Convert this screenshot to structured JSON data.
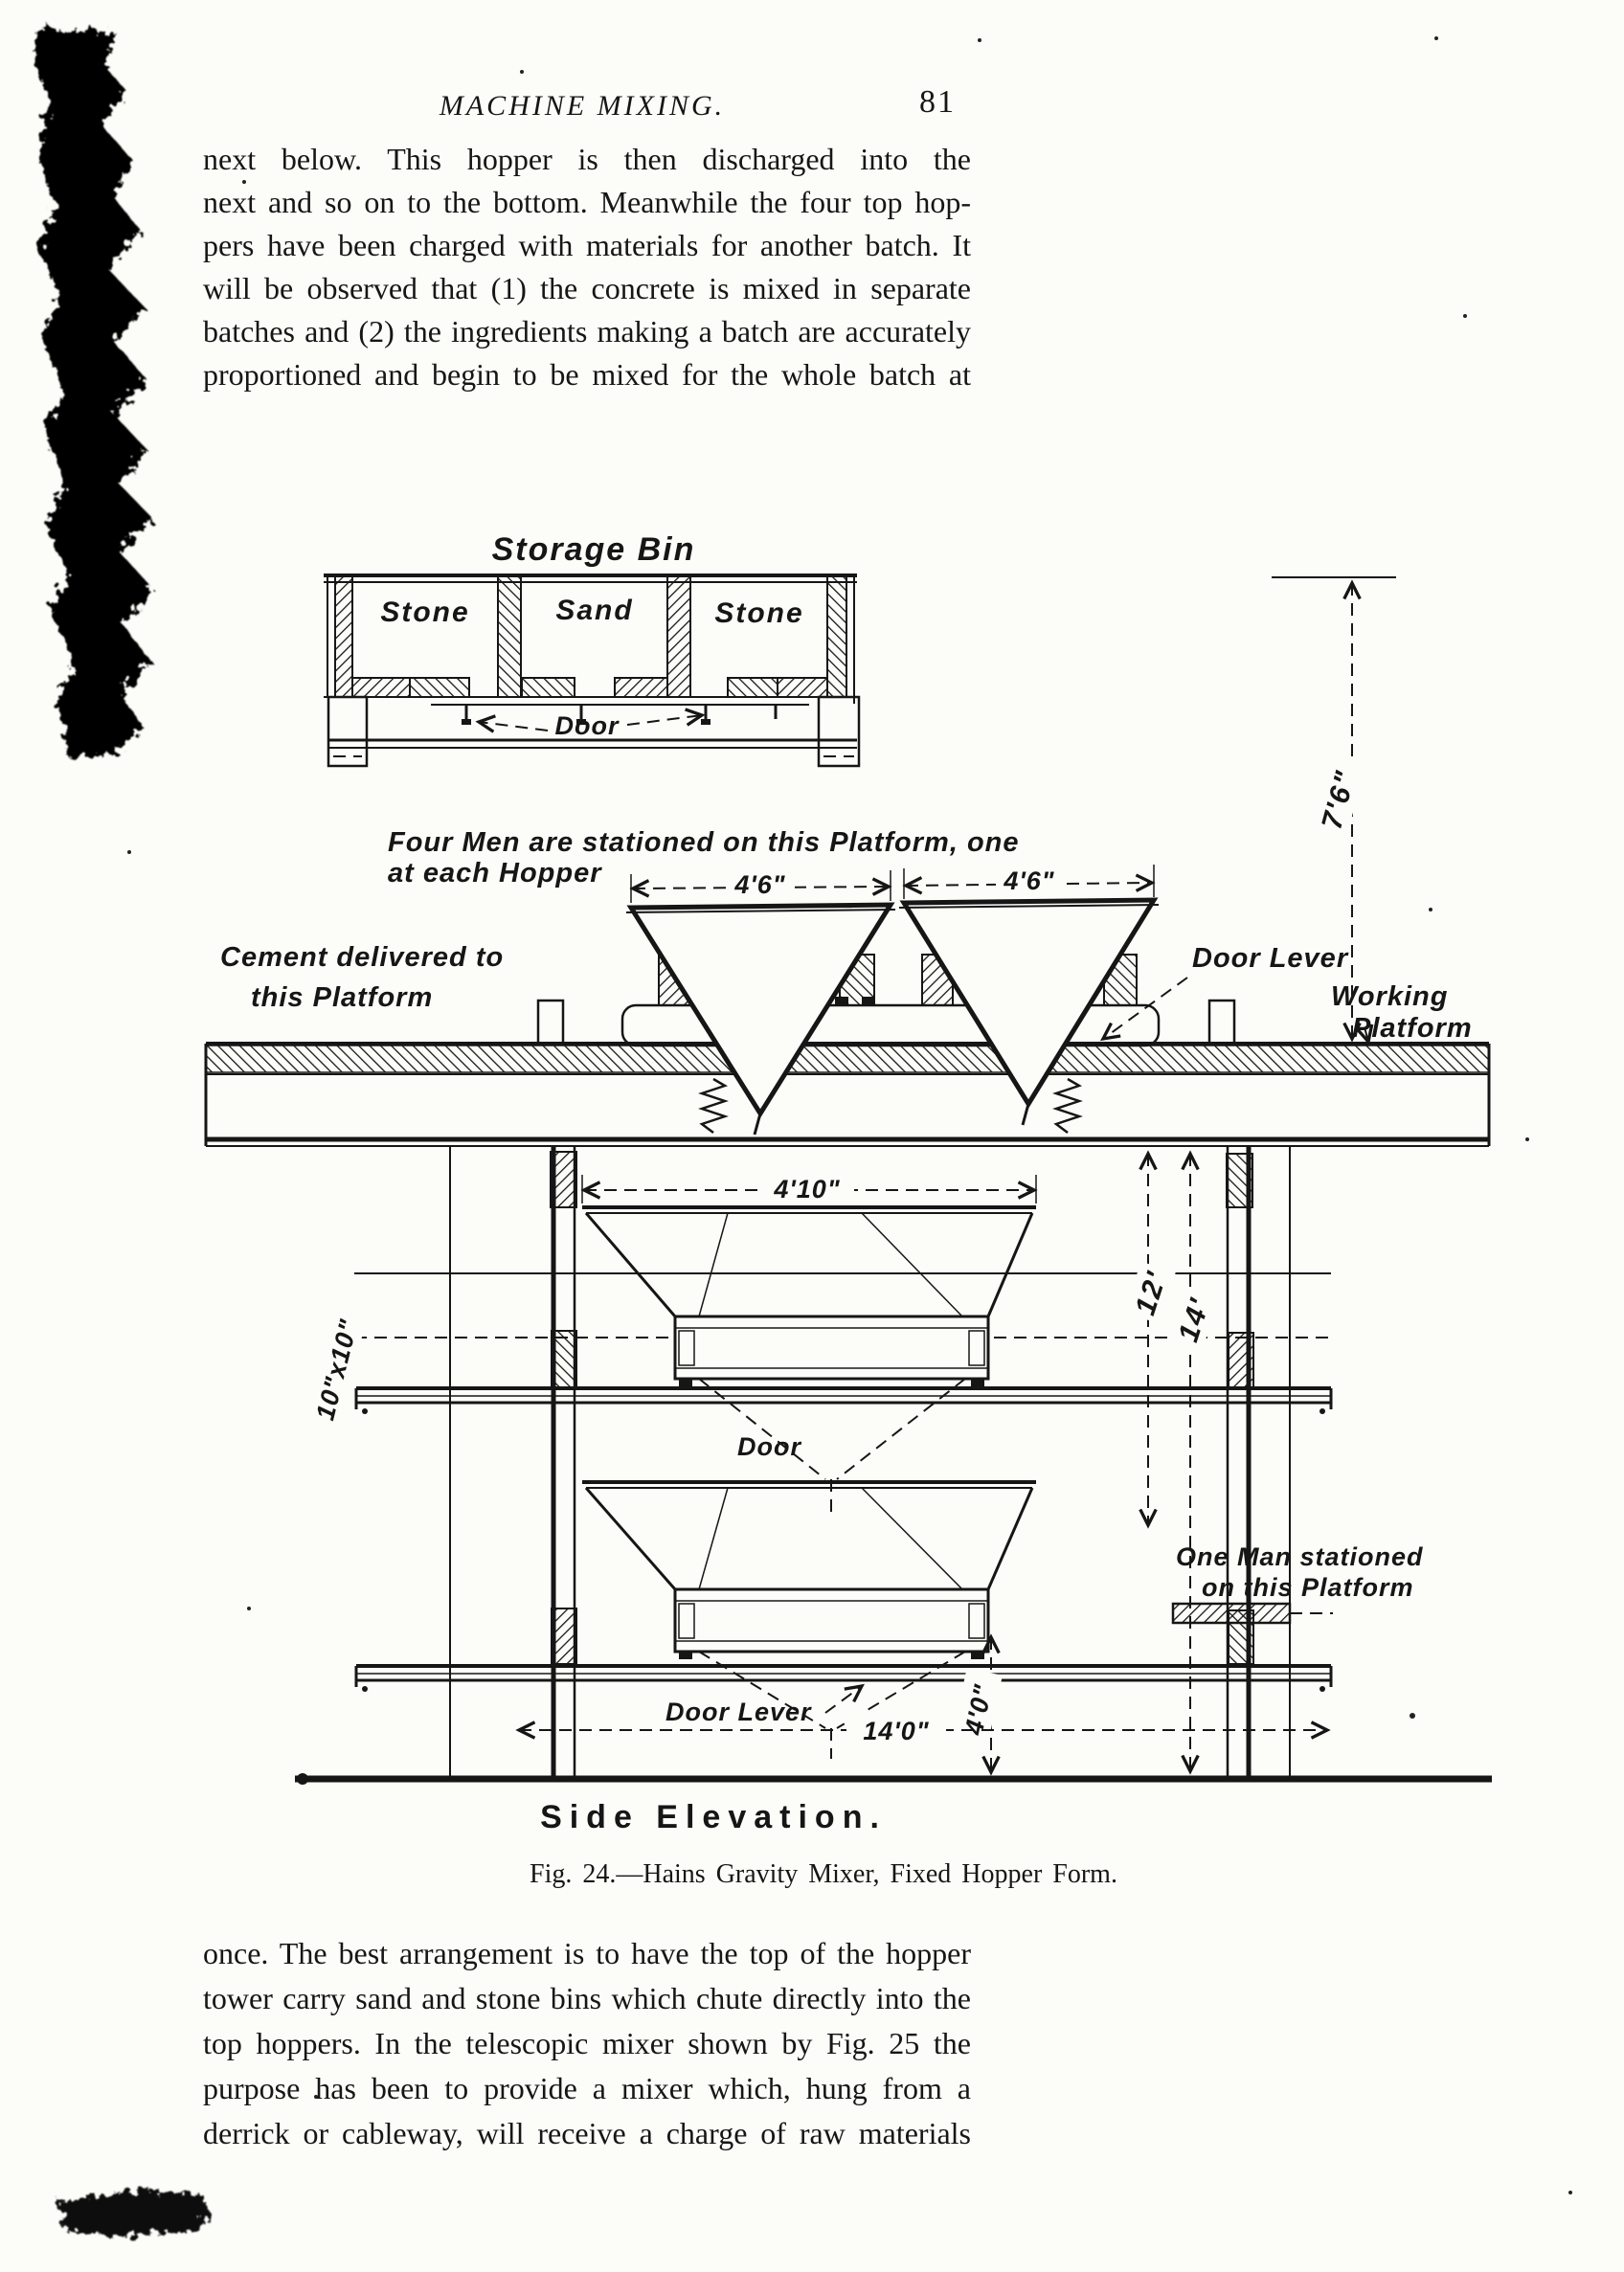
{
  "header": {
    "running_title": "MACHINE MIXING.",
    "page_number": "81"
  },
  "paragraphs": {
    "top": {
      "lines": [
        "next below. This hopper is then discharged into the",
        "next and so on to the bottom. Meanwhile the four top hop-",
        "pers have been charged with materials for another batch. It",
        "will be observed that (1) the concrete is mixed in separate",
        "batches and (2) the ingredients making a batch are accurately",
        "proportioned and begin to be mixed for the whole batch at"
      ]
    },
    "bottom": {
      "lines": [
        "once. The best arrangement is to have the top of the hopper",
        "tower carry sand and stone bins which chute directly into the",
        "top hoppers. In the telescopic mixer shown by Fig. 25 the",
        "purpose has been to provide a mixer which, hung from a",
        "derrick or cableway, will receive a charge of raw materials"
      ]
    }
  },
  "figure": {
    "title": "Storage Bin",
    "bins": [
      "Stone",
      "Sand",
      "Stone"
    ],
    "labels": {
      "door_top": "Door",
      "four_men_1": "Four Men are stationed on this Platform, one",
      "four_men_2": "at each Hopper",
      "cement_1": "Cement delivered to",
      "cement_2": "this Platform",
      "door_lever_upper": "Door Lever",
      "working_1": "Working",
      "working_2": "Platform",
      "door_mid": "Door",
      "one_man_1": "One Man stationed",
      "one_man_2": "on this Platform",
      "door_lever_lower": "Door Lever",
      "view": "Side Elevation."
    },
    "dimensions": {
      "seven_six": "7'6\"",
      "four_six_left": "4'6\"",
      "four_six_right": "4'6\"",
      "four_ten": "4'10\"",
      "twelve": "12'",
      "fourteen": "14'",
      "ten_by_ten": "10\"x10\"",
      "four_zero": "4'0\"",
      "fourteen_zero": "14'0\""
    },
    "caption": "Fig. 24.—Hains Gravity Mixer, Fixed Hopper Form."
  }
}
